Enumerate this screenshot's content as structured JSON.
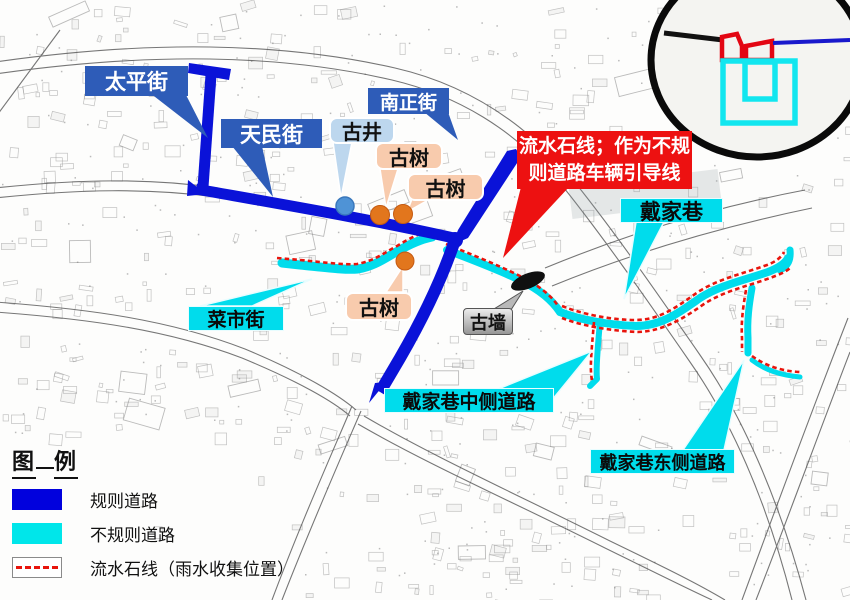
{
  "street_labels": {
    "taiping": "太平街",
    "tianmin": "天民街",
    "nanzheng": "南正街",
    "caishi": "菜市街",
    "daijiaxiang": "戴家巷",
    "daijia_mid": "戴家巷中侧道路",
    "daijia_east": "戴家巷东侧道路"
  },
  "feature_labels": {
    "gujing": "古井",
    "gushu_1": "古树",
    "gushu_2": "古树",
    "gushu_3": "古树",
    "guqiang": "古墙"
  },
  "callout": {
    "line1": "流水石线；作为不规",
    "line2": "则道路车辆引导线"
  },
  "legend": {
    "title_left": "图",
    "title_right": "例",
    "items": [
      {
        "label": "规则道路",
        "color": "#0101dd"
      },
      {
        "label": "不规则道路",
        "color": "#00e6ea"
      },
      {
        "label": "流水石线（雨水收集位置）",
        "color": "#e8140c"
      }
    ]
  },
  "colors": {
    "regular_road": "#0a12d8",
    "irregular_road": "#00dcec",
    "water_stone_line": "#e8140c",
    "street_label_bg": "#2e5cb8",
    "cyan_label_bg": "#00dcec",
    "well_label_bg": "#bdd7ee",
    "tree_label_bg": "#f8cbad",
    "wall_label_bg": "#c0c0c0",
    "callout_bg": "#ed1111",
    "well_marker": "#4f93d6",
    "tree_marker": "#e2761d"
  }
}
